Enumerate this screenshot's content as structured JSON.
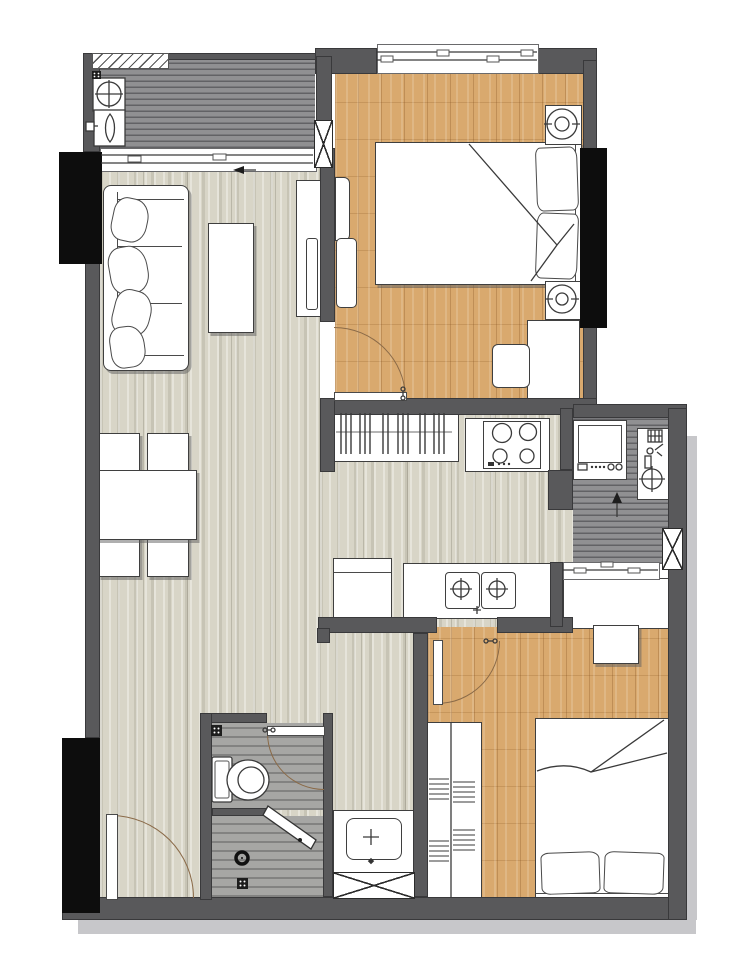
{
  "document": {
    "kind": "apartment-floor-plan",
    "text_labels": [],
    "orientation": "top-down rendered interior plan, no text or dimensions shown"
  },
  "palette": {
    "paper": "#ffffff",
    "wall": "#59595b",
    "column": "#0d0d0d",
    "floor-light": "#d8d5c7",
    "floor-oak": "#d9a96e",
    "floor-deck": "#909092",
    "floor-bath": "#a6a6a4",
    "outline": "#3f3f3f",
    "door-arc": "#8a6a48",
    "shadow": "#c7c7ca"
  },
  "inventory": {
    "rooms": [
      {
        "id": "ac-laundry-balcony",
        "position": "top-left",
        "floor": "dark-deck",
        "fixtures": [
          "louver-window",
          "floor-drain",
          "ac-outdoor-unit-fan",
          "propeller-fan-unit",
          "sliding-glass-door"
        ]
      },
      {
        "id": "living-dining-room",
        "position": "left",
        "floor": "light-wood",
        "furniture": [
          "three-seat-sofa",
          "sofa-cushions-x4",
          "coffee-table",
          "tv-console",
          "wall-tv",
          "dining-table",
          "dining-chair-x4"
        ]
      },
      {
        "id": "bedroom-1",
        "position": "top-right",
        "floor": "oak-wood",
        "furniture": [
          "double-bed",
          "pillows-x2",
          "nightstand-with-lamp-x2",
          "desk",
          "chair",
          "wall-panel-x2",
          "window"
        ]
      },
      {
        "id": "kitchen-corridor",
        "position": "center",
        "floor": "light-wood",
        "fixtures": [
          "hanger-closet",
          "four-burner-cooktop",
          "refrigerator",
          "double-bowl-sink-counter"
        ]
      },
      {
        "id": "utility-laundry-room",
        "position": "center-right",
        "floor": "dark-deck",
        "fixtures": [
          "washing-machine",
          "water-heater-counter",
          "gas-valve",
          "entry-arrow",
          "south-window"
        ]
      },
      {
        "id": "bedroom-2",
        "position": "bottom-right",
        "floor": "oak-wood",
        "furniture": [
          "double-bed",
          "pillows-x2",
          "shelved-wardrobe",
          "built-in-closet",
          "desk"
        ]
      },
      {
        "id": "bathroom",
        "position": "bottom-center",
        "floor": "gray-wood",
        "fixtures": [
          "toilet",
          "floor-drain-x2",
          "shower-head",
          "swing-shower-door"
        ]
      },
      {
        "id": "vanity-nook",
        "position": "bottom-center-right",
        "fixtures": [
          "washbasin-counter",
          "x-marked-cabinet"
        ]
      }
    ],
    "doors": [
      {
        "id": "entry-door",
        "location": "bottom-left wall",
        "swing": "inward quarter-arc"
      },
      {
        "id": "bedroom-1-door",
        "location": "west wall of bedroom 1",
        "swing": "into bedroom"
      },
      {
        "id": "bedroom-2-door",
        "location": "north wall of bedroom 2",
        "swing": "into bedroom"
      },
      {
        "id": "bathroom-door",
        "location": "north wall of bathroom",
        "swing": "into bathroom"
      }
    ],
    "windows": [
      "bedroom-1-north-window",
      "balcony-louver-window",
      "balcony-sliding-door-band",
      "utility-south-window"
    ],
    "structural": [
      "black-column-left-upper",
      "black-column-left-lower",
      "black-column-right",
      "x-shaft-balcony-wall",
      "x-shaft-utility-wall"
    ]
  }
}
